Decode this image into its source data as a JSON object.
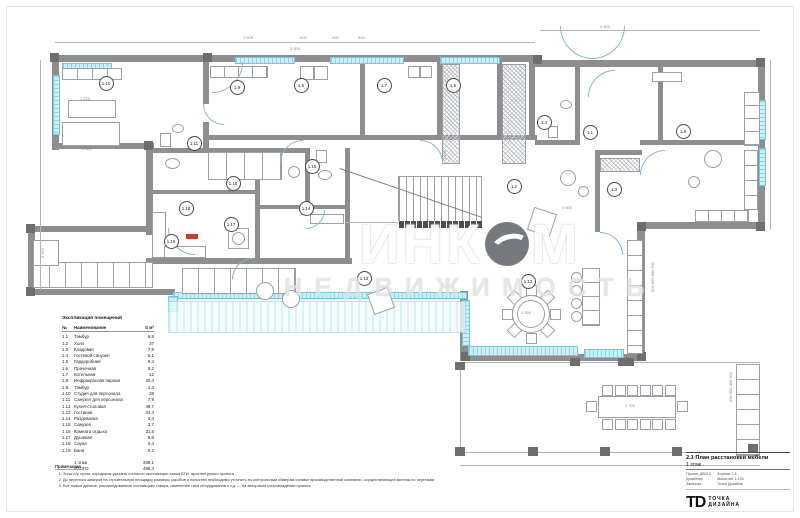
{
  "watermark": {
    "part1": "ИНК",
    "part2": "М",
    "subtitle": "НЕДВИЖИМОСТЬ"
  },
  "legend": {
    "title": "Экспликация помещений",
    "col_no": "№",
    "col_name": "Наименование",
    "col_area": "S м²",
    "rows": [
      {
        "no": "1.1",
        "name": "Тамбур",
        "area": "6,8"
      },
      {
        "no": "1.2",
        "name": "Холл",
        "area": "37"
      },
      {
        "no": "1.3",
        "name": "Кладовая",
        "area": "7,9"
      },
      {
        "no": "1.4",
        "name": "Гостевой санузел",
        "area": "5,1"
      },
      {
        "no": "1.5",
        "name": "Гардеробная",
        "area": "9,4"
      },
      {
        "no": "1.6",
        "name": "Прачечная",
        "area": "9,2"
      },
      {
        "no": "1.7",
        "name": "Котельная",
        "area": "12"
      },
      {
        "no": "1.8",
        "name": "Инфракрасная парная",
        "area": "20,4"
      },
      {
        "no": "1.9",
        "name": "Тамбур",
        "area": "4,3"
      },
      {
        "no": "1.10",
        "name": "Студия для персонала",
        "area": "28"
      },
      {
        "no": "1.11",
        "name": "Санузел для персонала",
        "area": "7,9"
      },
      {
        "no": "1.12",
        "name": "Кухня-столовая",
        "area": "49,7"
      },
      {
        "no": "1.13",
        "name": "Гостиная",
        "area": "34,4"
      },
      {
        "no": "1.14",
        "name": "Раздевалка",
        "area": "3,4"
      },
      {
        "no": "1.15",
        "name": "Санузел",
        "area": "3,7"
      },
      {
        "no": "1.16",
        "name": "Комната отдыха",
        "area": "31,5"
      },
      {
        "no": "1.17",
        "name": "Душевая",
        "area": "6,8"
      },
      {
        "no": "1.18",
        "name": "Сауна",
        "area": "6,4"
      },
      {
        "no": "1.19",
        "name": "Баня",
        "area": "5,2"
      }
    ],
    "totals": [
      {
        "label": "1 этаж",
        "value": "289,1"
      },
      {
        "label": "ИТОГО",
        "value": "498,4"
      }
    ]
  },
  "notes": {
    "title": "Примечания",
    "items": [
      "Зоны с/у, кухни, коридоров указаны согласно экспликации этажа БТИ, архитектурного проекта",
      "До переноса замеров на строительную площадку размеры коробов и полостей необходимо уточнить по контрольным обмерам силами производственной компании, осуществляющей монтаж по чертежам",
      "Все новые данные, рекомендованные поставщики товара, изменения типа оборудования и т.д. — на авторском сопровождении проекта"
    ]
  },
  "titleblock": {
    "doc_title": "2.1 План расстановки мебели",
    "floor": "1 этаж",
    "meta_left": [
      "Проект ДВ010",
      "Дизайнер",
      "Заказчик"
    ],
    "meta_right": [
      "Формат 2.1",
      "Масштаб 1:100",
      "Точка Дизайна"
    ],
    "logo_td": "ТD",
    "brand_line1": "ТОЧКА",
    "brand_line2": "ДИЗАЙНА"
  },
  "plan": {
    "rooms": [
      {
        "n": "1.1",
        "x": 589,
        "y": 131
      },
      {
        "n": "1.2",
        "x": 513,
        "y": 185
      },
      {
        "n": "1.3",
        "x": 613,
        "y": 188
      },
      {
        "n": "1.4",
        "x": 543,
        "y": 121
      },
      {
        "n": "1.5",
        "x": 452,
        "y": 84
      },
      {
        "n": "1.6",
        "x": 300,
        "y": 84
      },
      {
        "n": "1.7",
        "x": 383,
        "y": 84
      },
      {
        "n": "1.8",
        "x": 682,
        "y": 130
      },
      {
        "n": "1.9",
        "x": 236,
        "y": 86
      },
      {
        "n": "1.10",
        "x": 105,
        "y": 82
      },
      {
        "n": "1.11",
        "x": 193,
        "y": 142
      },
      {
        "n": "1.12",
        "x": 527,
        "y": 280
      },
      {
        "n": "1.13",
        "x": 363,
        "y": 277
      },
      {
        "n": "1.14",
        "x": 305,
        "y": 207
      },
      {
        "n": "1.15",
        "x": 311,
        "y": 165
      },
      {
        "n": "1.16",
        "x": 232,
        "y": 182
      },
      {
        "n": "1.17",
        "x": 230,
        "y": 223
      },
      {
        "n": "1.18",
        "x": 185,
        "y": 207
      },
      {
        "n": "1.19",
        "x": 170,
        "y": 240
      }
    ],
    "dims": [
      {
        "t": "1 509",
        "x": 243,
        "y": 35
      },
      {
        "t": "600",
        "x": 300,
        "y": 35
      },
      {
        "t": "400",
        "x": 332,
        "y": 35
      },
      {
        "t": "800",
        "x": 358,
        "y": 35
      },
      {
        "t": "3 300",
        "x": 290,
        "y": 46
      },
      {
        "t": "4 500",
        "x": 600,
        "y": 24
      },
      {
        "t": "1 220",
        "x": 80,
        "y": 96
      },
      {
        "t": "2 800",
        "x": 82,
        "y": 146
      },
      {
        "t": "1 500",
        "x": 562,
        "y": 205
      },
      {
        "t": "1 100",
        "x": 442,
        "y": 160,
        "rot": 1
      },
      {
        "t": "5 559",
        "x": 40,
        "y": 258,
        "rot": 1
      },
      {
        "t": "1 390",
        "x": 521,
        "y": 310
      },
      {
        "t": "2 700",
        "x": 625,
        "y": 403
      },
      {
        "t": "600  800  800  600",
        "x": 650,
        "y": 292,
        "rot": 1
      },
      {
        "t": "500  900  400  900",
        "x": 728,
        "y": 402,
        "rot": 1
      }
    ]
  },
  "colors": {
    "wall": "#8e8e8e",
    "window": "#cdeef7",
    "line": "#9aa0a6",
    "dark": "#4c4c4c",
    "red": "#cc3b2e"
  }
}
